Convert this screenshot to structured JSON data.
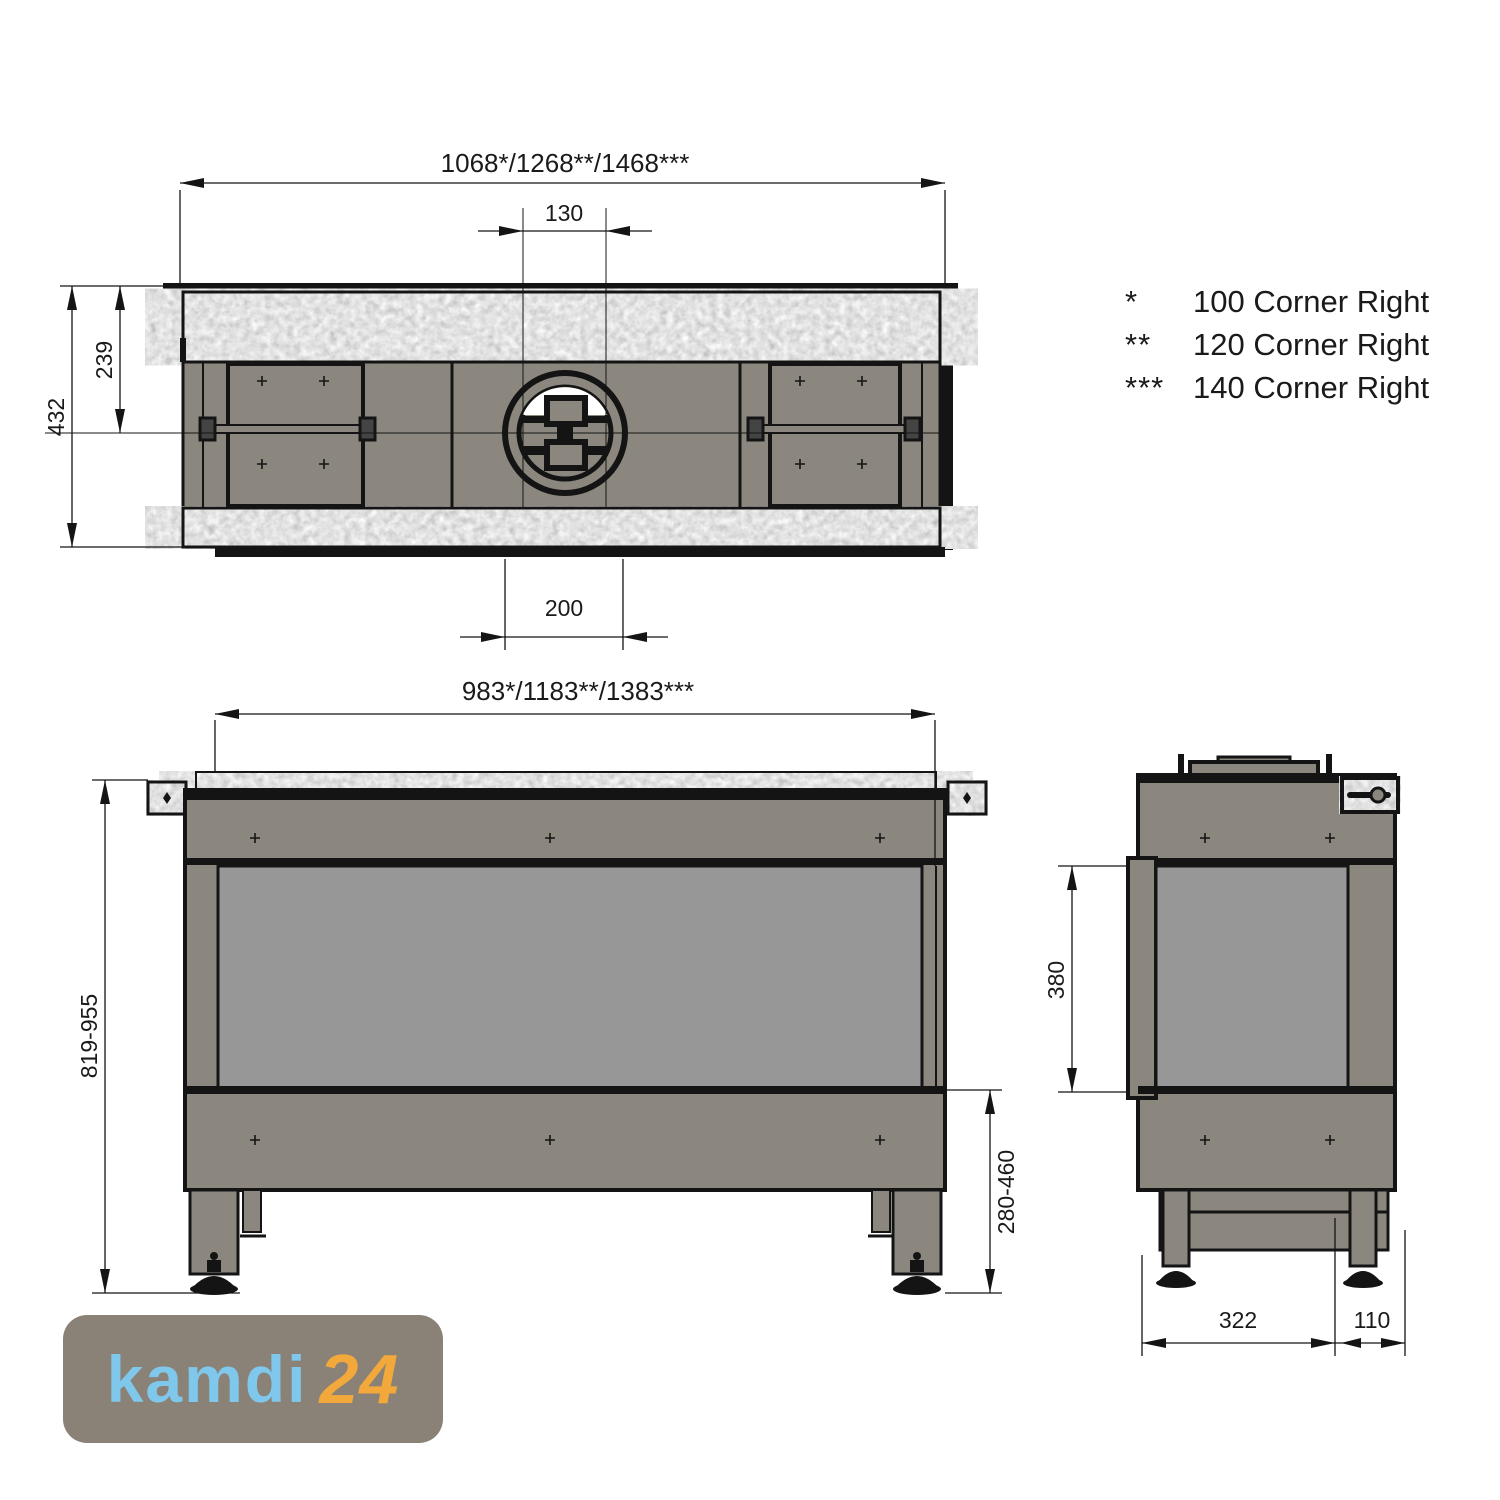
{
  "colors": {
    "body_taupe": "#8b877e",
    "glass_gray": "#979797",
    "line_black": "#141414",
    "logo_bg": "#8a8177",
    "logo_blue": "#7fc8ec",
    "logo_orange": "#f3a83c"
  },
  "legend": {
    "items": [
      {
        "marker": "*",
        "label": "100 Corner Right"
      },
      {
        "marker": "**",
        "label": "120 Corner Right"
      },
      {
        "marker": "***",
        "label": "140 Corner Right"
      }
    ]
  },
  "top_view": {
    "dim_width": "1068*/1268**/1468***",
    "dim_flue_offset": "130",
    "dim_depth_total": "432",
    "dim_depth_front": "239",
    "dim_flue_center": "200"
  },
  "front_view": {
    "dim_width": "983*/1183**/1383***",
    "dim_height": "819-955",
    "dim_leg_height": "280-460"
  },
  "side_view": {
    "dim_glass_height": "380",
    "dim_depth_back": "322",
    "dim_depth_front": "110"
  },
  "logo": {
    "word": "kamdi",
    "number": "24"
  }
}
